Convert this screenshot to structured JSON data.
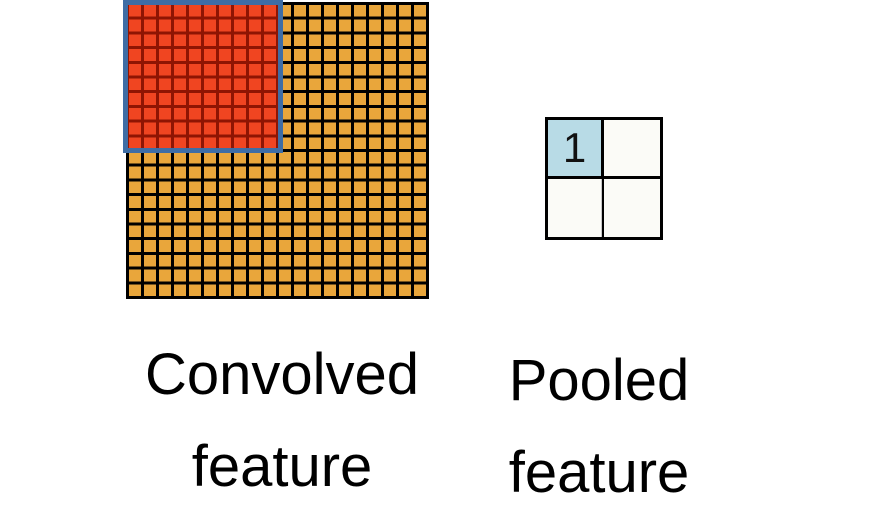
{
  "diagram": {
    "convolved": {
      "label_lines": [
        "Convolved",
        "feature"
      ],
      "grid": {
        "cols": 20,
        "rows": 20,
        "cell_color": "#E9A63B",
        "line_color": "#000000"
      },
      "pooling_window": {
        "cols": 10,
        "rows": 10,
        "cell_color": "#F04521",
        "line_color": "#8F1503",
        "frame_color": "#3E6DA5"
      }
    },
    "pooled": {
      "label_lines": [
        "Pooled",
        "feature"
      ],
      "grid": {
        "cols": 2,
        "rows": 2,
        "cells": [
          "1",
          "",
          "",
          ""
        ],
        "highlight_cell_color": "#B8DBE6",
        "cell_color": "#FBFBF7",
        "line_color": "#000000"
      }
    }
  }
}
